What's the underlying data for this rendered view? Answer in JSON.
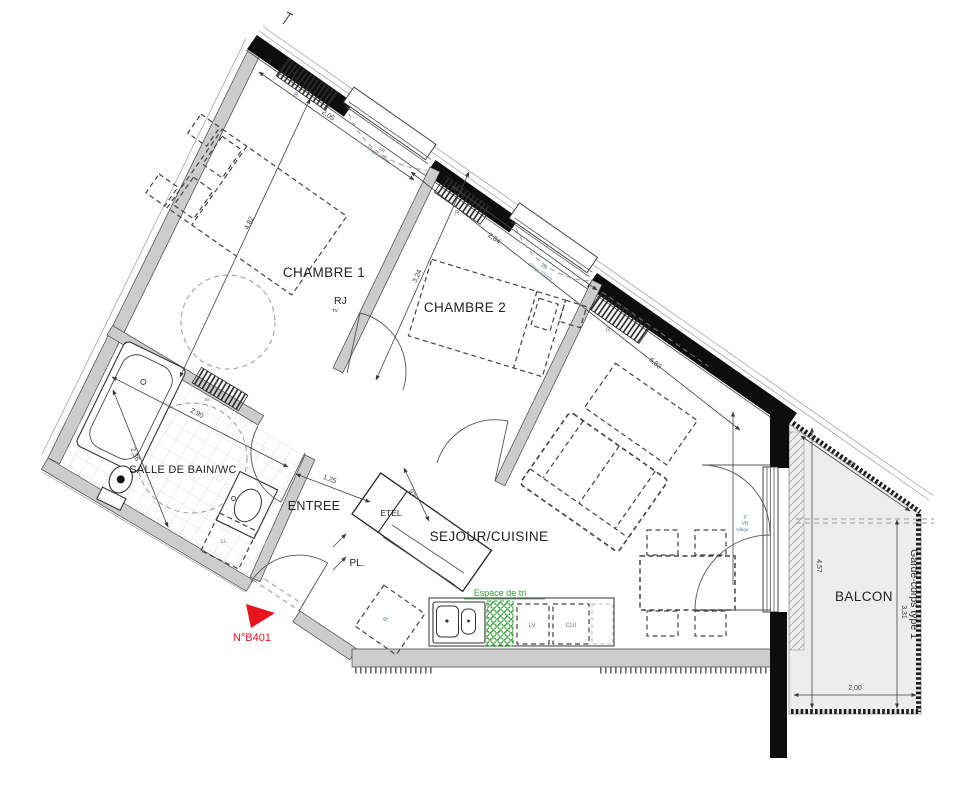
{
  "plan": {
    "unit_number": "N°B401",
    "labels": {
      "chambre1": "CHAMBRE 1",
      "chambre2": "CHAMBRE 2",
      "salle_de_bain": "SALLE DE BAIN/WC",
      "entree": "ENTREE",
      "etel": "ETEL",
      "placard": "PL.",
      "sejour": "SEJOUR/CUISINE",
      "balcon": "BALCON",
      "espace_de_tri": "Espace de tri",
      "garde_corps": "Garde-corps type 1",
      "rj": "RJ",
      "tv": "TV",
      "radiator": "R",
      "fridge": "R",
      "seche_serviettes": "ss",
      "lave_linge": "LL",
      "lave_vaisselle": "LV",
      "cuisiniere": "CUI",
      "window_vr": "VR",
      "window_allege": "Allège 100cm",
      "door_f": "F",
      "door_vr": "VR",
      "door_allege": "Allège"
    },
    "dims": {
      "c1_w": "2,05",
      "c1_l": "4,82",
      "c2_w": "2,84",
      "c2_l": "3,24",
      "sej_l": "6,83",
      "ent_w": "1,25",
      "ent_d": "97",
      "sdb_w": "2,90",
      "sdb_l": "2,35",
      "bal_diag": "2,38",
      "bal_l1": "4,57",
      "bal_l2": "3,31",
      "bal_w": "2,00"
    },
    "colors": {
      "accent_red": "#e8141e",
      "accent_green": "#2f9e33",
      "wall_black": "#0d0d0d",
      "wall_grey": "#cccccc",
      "balcony_floor": "#ededee"
    }
  }
}
